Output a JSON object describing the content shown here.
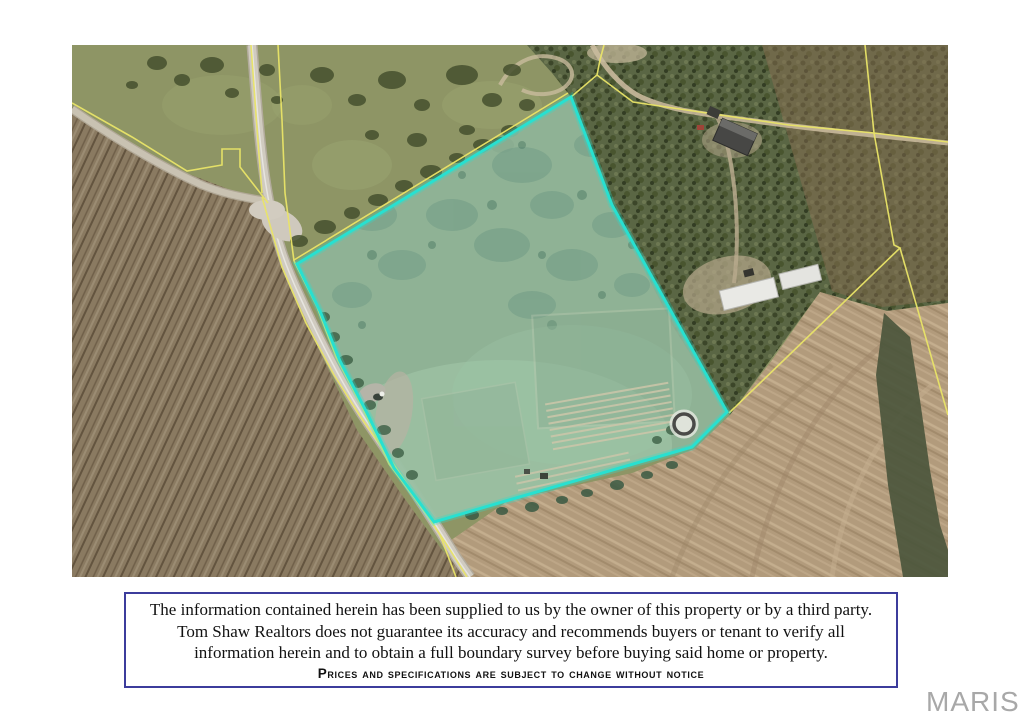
{
  "map": {
    "type": "aerial-photo",
    "parcel_outline_color": "#28e0d0",
    "boundary_line_color": "#e9e468",
    "road_color": "#d0cbc0",
    "marker": "circle-marker-at-east-corner"
  },
  "disclaimer": {
    "border_color": "#3c3c9c",
    "lines": [
      "The information  contained herein has been supplied to us by the owner of this property or by a third party.",
      "Tom Shaw Realtors  does not guarantee its accuracy  and recommends buyers or tenant to verify all",
      "information herein and  to obtain a full boundary survey before buying said home or property.",
      "Prices and specifications are subject to change without notice"
    ]
  },
  "watermark": {
    "text": "MARIS",
    "color": "#a8a8a8"
  }
}
